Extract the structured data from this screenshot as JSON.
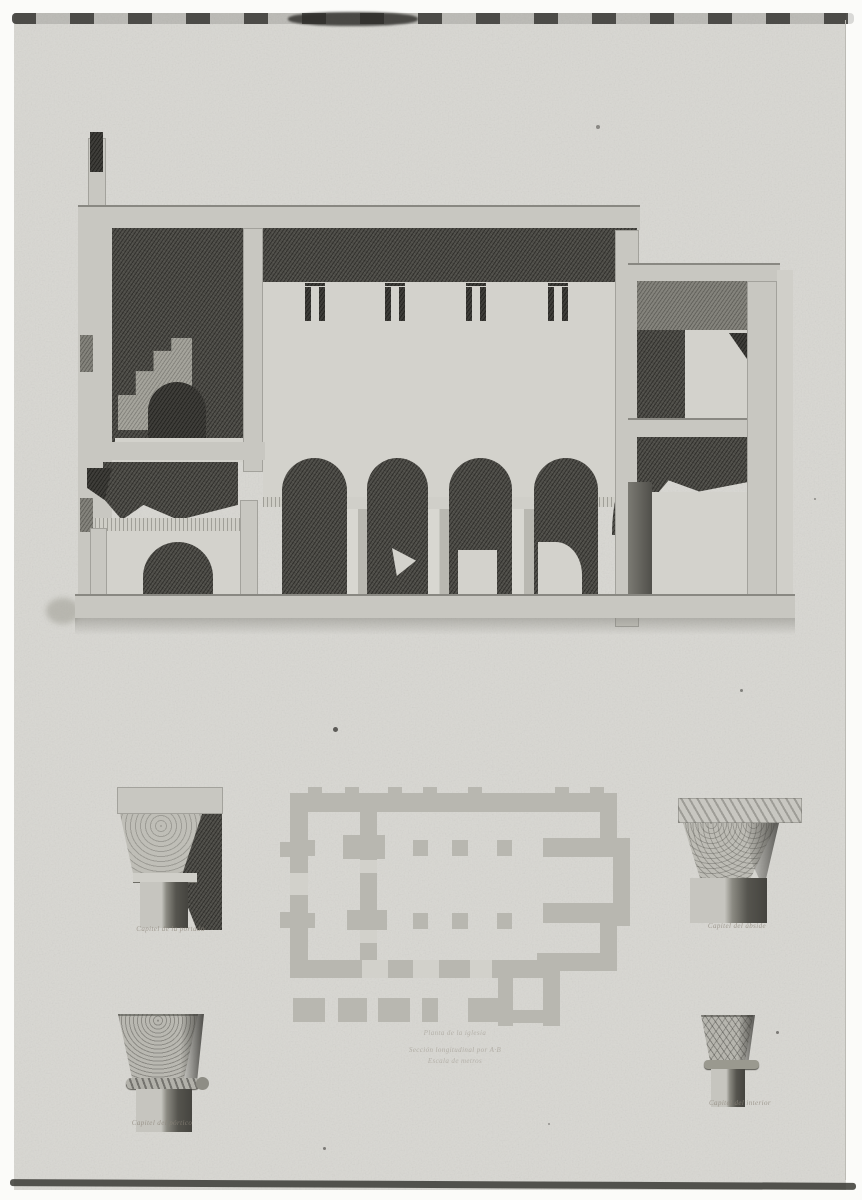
{
  "plate": {
    "kind": "architectural engraving plate",
    "drawings": {
      "section": "longitudinal section of church with arcade and portico",
      "plan": "floor plan with portico and chancel",
      "details": "four carved column capitals"
    }
  },
  "captions": {
    "capital_top_left": "Capitel de la portada",
    "capital_top_right": "Capitel del ábside",
    "capital_bottom_left": "Capitel del pórtico",
    "capital_bottom_right": "Capitel del interior",
    "plan_line1": "Planta de la iglesia",
    "plan_line2": "Sección longitudinal por A·B",
    "plan_line3": "Escala de metros"
  },
  "colors": {
    "paper": "#d8d7d2",
    "print_dark": "#4e4d48",
    "print_light": "#c8c7c1",
    "plan_wall": "#b6b5ae",
    "scan_edge": "#343330"
  }
}
